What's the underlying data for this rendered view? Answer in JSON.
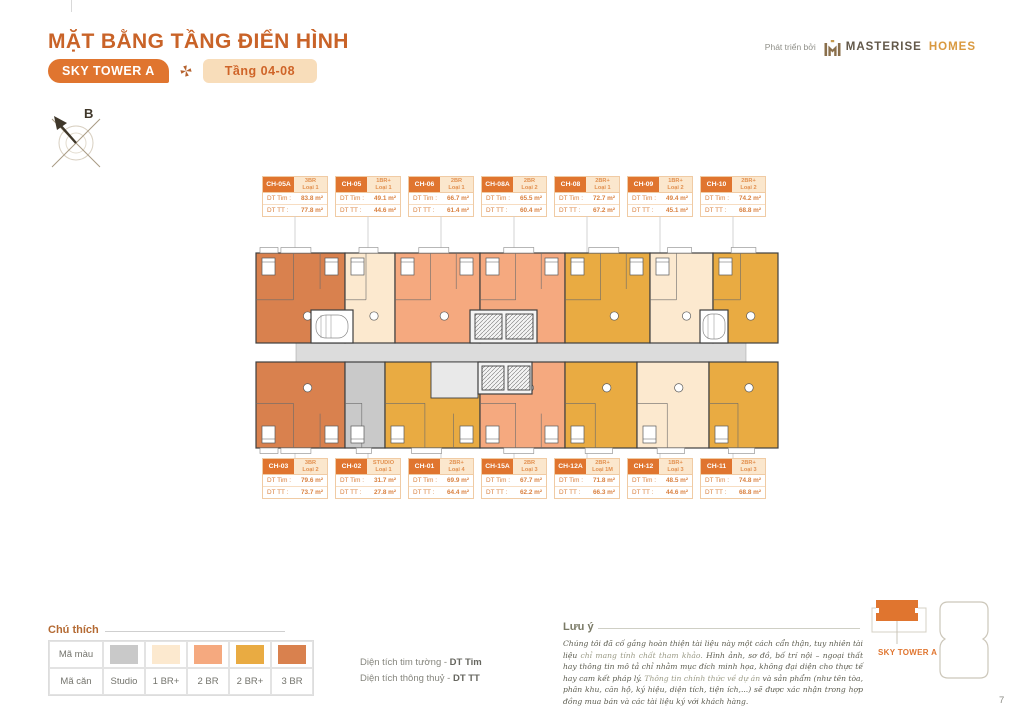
{
  "header": {
    "title": "MẶT BẰNG TẦNG ĐIỂN HÌNH",
    "tower_badge": "SKY TOWER A",
    "floor_badge": "Tầng 04-08",
    "developer_prefix": "Phát triển bởi",
    "brand_name_1": "MASTERISE",
    "brand_name_2": "HOMES"
  },
  "compass": {
    "label": "B"
  },
  "labels": {
    "dt_tim": "DT Tim :",
    "dt_tt": "DT TT :"
  },
  "plan": {
    "top_units": [
      {
        "code": "CH-05A",
        "type": "3BR",
        "variant": "Loại 1",
        "dt_tim": "83.8 m²",
        "dt_tt": "77.8 m²"
      },
      {
        "code": "CH-05",
        "type": "1BR+",
        "variant": "Loại 1",
        "dt_tim": "49.1 m²",
        "dt_tt": "44.6 m²"
      },
      {
        "code": "CH-06",
        "type": "2BR",
        "variant": "Loại 1",
        "dt_tim": "66.7 m²",
        "dt_tt": "61.4 m²"
      },
      {
        "code": "CH-08A",
        "type": "2BR",
        "variant": "Loại 2",
        "dt_tim": "65.5 m²",
        "dt_tt": "60.4 m²"
      },
      {
        "code": "CH-08",
        "type": "2BR+",
        "variant": "Loại 1",
        "dt_tim": "72.7 m²",
        "dt_tt": "67.2 m²"
      },
      {
        "code": "CH-09",
        "type": "1BR+",
        "variant": "Loại 2",
        "dt_tim": "49.4 m²",
        "dt_tt": "45.1 m²"
      },
      {
        "code": "CH-10",
        "type": "2BR+",
        "variant": "Loại 2",
        "dt_tim": "74.2 m²",
        "dt_tt": "68.8 m²"
      }
    ],
    "bottom_units": [
      {
        "code": "CH-03",
        "type": "3BR",
        "variant": "Loại 2",
        "dt_tim": "79.6 m²",
        "dt_tt": "73.7 m²"
      },
      {
        "code": "CH-02",
        "type": "STUDIO",
        "variant": "Loại 1",
        "dt_tim": "31.7 m²",
        "dt_tt": "27.8 m²"
      },
      {
        "code": "CH-01",
        "type": "2BR+",
        "variant": "Loại 4",
        "dt_tim": "69.9 m²",
        "dt_tt": "64.4 m²"
      },
      {
        "code": "CH-15A",
        "type": "2BR",
        "variant": "Loại 3",
        "dt_tim": "67.7 m²",
        "dt_tt": "62.2 m²"
      },
      {
        "code": "CH-12A",
        "type": "2BR+",
        "variant": "Loại 1M",
        "dt_tim": "71.8 m²",
        "dt_tt": "66.3 m²"
      },
      {
        "code": "CH-12",
        "type": "1BR+",
        "variant": "Loại 3",
        "dt_tim": "48.5 m²",
        "dt_tt": "44.6 m²"
      },
      {
        "code": "CH-11",
        "type": "2BR+",
        "variant": "Loại 3",
        "dt_tim": "74.8 m²",
        "dt_tt": "68.8 m²"
      }
    ]
  },
  "legend": {
    "title": "Chú thích",
    "row1_label": "Mã màu",
    "row2_label": "Mã căn",
    "items": [
      {
        "key": "studio",
        "name": "Studio",
        "color": "#c9c9c9"
      },
      {
        "key": "1brp",
        "name": "1 BR+",
        "color": "#fce9cf"
      },
      {
        "key": "2br",
        "name": "2 BR",
        "color": "#f5a97f"
      },
      {
        "key": "2brp",
        "name": "2 BR+",
        "color": "#e9ab42"
      },
      {
        "key": "3br",
        "name": "3 BR",
        "color": "#d9814e"
      }
    ]
  },
  "definitions": {
    "line1_text": "Diện tích tim tường - ",
    "line1_bold": "DT Tim",
    "line2_text": "Diện tích thông thuỷ - ",
    "line2_bold": "DT TT"
  },
  "note": {
    "title": "Lưu ý",
    "seg1": "Chúng tôi đã cố gắng hoàn thiện tài liệu này một cách cẩn thận, tuy nhiên tài liệu ",
    "seg2": "chỉ mang tính chất tham khảo. ",
    "seg3": "Hình ảnh, sơ đồ, bố trí nội – ngoại thất hay thông tin mô tả chỉ nhằm mục đích minh họa, không đại diện cho thực tế hay cam kết pháp lý. ",
    "seg4": "Thông tin chính thức về dự án ",
    "seg5": "và sản phẩm (như tên tòa, phân khu, căn hộ, ký hiệu, diện tích, tiện ích,...) sẽ được xác nhận trong hợp đồng mua bán và các tài liệu ký với khách hàng."
  },
  "minimap": {
    "label": "SKY TOWER A"
  },
  "page_number": "7",
  "colors": {
    "accent_orange": "#e0752f",
    "title_orange": "#c96328",
    "corridor_gray": "#dcdcdc",
    "wall_dark": "#3f3f3f"
  }
}
